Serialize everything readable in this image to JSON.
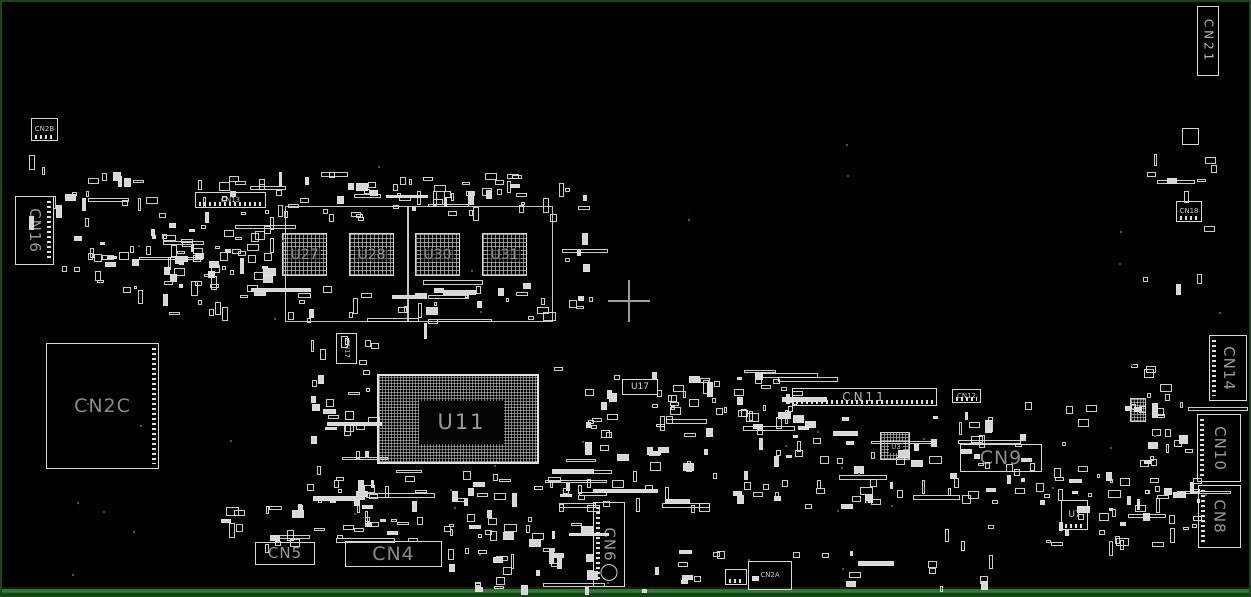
{
  "app": {
    "type": "pcb-boardview-screen",
    "background": "#000000",
    "border_color": "#1e431e",
    "silkscreen_color": "#d8d8d8",
    "label_color": "#8f8f8f",
    "edge_strip_color": "#247524"
  },
  "crosshair": {
    "x": 627,
    "y": 299,
    "arm": 21,
    "thickness": 2,
    "color": "#a39a9e"
  },
  "components": [
    {
      "id": "CN21",
      "label": "CN21",
      "x": 1195,
      "y": 4,
      "w": 22,
      "h": 70,
      "type": "box",
      "ls": "sm2",
      "vert": true
    },
    {
      "id": "CN2B",
      "label": "CN2B",
      "x": 29,
      "y": 116,
      "w": 27,
      "h": 23,
      "type": "box",
      "ls": "xs",
      "pins": "bottom"
    },
    {
      "id": "CN16",
      "label": "CN16",
      "x": 13,
      "y": 194,
      "w": 39,
      "h": 69,
      "type": "box",
      "ls": "md",
      "vert": true,
      "pins": "right"
    },
    {
      "id": "CN13",
      "label": "CN13",
      "x": 193,
      "y": 190,
      "w": 71,
      "h": 16,
      "type": "box",
      "ls": "xs",
      "pins": "bottom"
    },
    {
      "id": "CN2C",
      "label": "CN2C",
      "x": 44,
      "y": 341,
      "w": 113,
      "h": 126,
      "type": "box",
      "ls": "lg",
      "pins": "right"
    },
    {
      "id": "CN17",
      "label": "CN17",
      "x": 334,
      "y": 331,
      "w": 21,
      "h": 31,
      "type": "box",
      "ls": "xs",
      "vert": true
    },
    {
      "id": "U27",
      "label": "U27",
      "x": 280,
      "y": 231,
      "w": 45,
      "h": 43,
      "type": "mem"
    },
    {
      "id": "U28",
      "label": "U28",
      "x": 347,
      "y": 231,
      "w": 45,
      "h": 43,
      "type": "mem"
    },
    {
      "id": "U30",
      "label": "U30",
      "x": 413,
      "y": 231,
      "w": 45,
      "h": 43,
      "type": "mem"
    },
    {
      "id": "U31",
      "label": "U31",
      "x": 480,
      "y": 231,
      "w": 45,
      "h": 43,
      "type": "mem"
    },
    {
      "id": "U11",
      "label": "U11",
      "x": 375,
      "y": 372,
      "w": 162,
      "h": 90,
      "type": "cpu",
      "core": {
        "dx": 40,
        "dy": 25,
        "w": 85,
        "h": 43
      }
    },
    {
      "id": "U17",
      "label": "U17",
      "x": 620,
      "y": 377,
      "w": 36,
      "h": 16,
      "type": "box",
      "ls": "sm"
    },
    {
      "id": "CN11",
      "label": "CN11",
      "x": 790,
      "y": 386,
      "w": 145,
      "h": 18,
      "type": "box",
      "ls": "sm2",
      "pins": "bottom"
    },
    {
      "id": "CN12",
      "label": "CN12",
      "x": 950,
      "y": 387,
      "w": 29,
      "h": 14,
      "type": "box",
      "ls": "xs",
      "pins": "bottom"
    },
    {
      "id": "U3",
      "label": "U3",
      "x": 878,
      "y": 430,
      "w": 30,
      "h": 28,
      "type": "bga",
      "core": {
        "dx": 8,
        "dy": 9,
        "w": 14,
        "h": 11
      }
    },
    {
      "id": "CN9",
      "label": "CN9",
      "x": 958,
      "y": 442,
      "w": 82,
      "h": 28,
      "type": "box",
      "ls": "lg"
    },
    {
      "id": "U7",
      "label": "U7",
      "x": 1059,
      "y": 498,
      "w": 27,
      "h": 30,
      "type": "box",
      "ls": "sm",
      "pins": "bottom"
    },
    {
      "id": "CN18",
      "label": "CN18",
      "x": 1174,
      "y": 199,
      "w": 26,
      "h": 21,
      "type": "box",
      "ls": "xs",
      "pins": "bottom"
    },
    {
      "id": "CN14",
      "label": "CN14",
      "x": 1207,
      "y": 333,
      "w": 38,
      "h": 66,
      "type": "box",
      "ls": "md",
      "vert": true,
      "pins": "left"
    },
    {
      "id": "CN10",
      "label": "CN10",
      "x": 1195,
      "y": 412,
      "w": 44,
      "h": 68,
      "type": "box",
      "ls": "md",
      "vert": true,
      "pins": "left"
    },
    {
      "id": "CN8",
      "label": "CN8",
      "x": 1196,
      "y": 483,
      "w": 43,
      "h": 63,
      "type": "box",
      "ls": "md",
      "vert": true,
      "pins": "left"
    },
    {
      "id": "CN5",
      "label": "CN5",
      "x": 253,
      "y": 540,
      "w": 60,
      "h": 23,
      "type": "box",
      "ls": "md"
    },
    {
      "id": "CN4",
      "label": "CN4",
      "x": 343,
      "y": 539,
      "w": 97,
      "h": 26,
      "type": "box",
      "ls": "lg"
    },
    {
      "id": "CN6",
      "label": "CN6",
      "x": 591,
      "y": 500,
      "w": 32,
      "h": 85,
      "type": "box",
      "ls": "md",
      "vert": true,
      "pins": "left",
      "hole": true
    },
    {
      "id": "CN2A",
      "label": "CN2A",
      "x": 746,
      "y": 559,
      "w": 44,
      "h": 29,
      "type": "box",
      "ls": "xs"
    },
    {
      "id": "conn-small-1",
      "label": "",
      "x": 723,
      "y": 567,
      "w": 22,
      "h": 16,
      "type": "box",
      "pins": "bottom"
    },
    {
      "id": "chip-sq-1",
      "label": "",
      "x": 1180,
      "y": 126,
      "w": 17,
      "h": 17,
      "type": "box"
    },
    {
      "id": "bga-sm-1",
      "label": "",
      "x": 1128,
      "y": 396,
      "w": 16,
      "h": 24,
      "type": "bgapad"
    }
  ],
  "frames": [
    {
      "x": 283,
      "y": 204,
      "w": 123,
      "h": 116
    },
    {
      "x": 406,
      "y": 204,
      "w": 145,
      "h": 116
    }
  ],
  "clusters": [
    {
      "x": 62,
      "y": 168,
      "w": 205,
      "h": 120,
      "n": 85,
      "seed": 1
    },
    {
      "x": 150,
      "y": 232,
      "w": 120,
      "h": 78,
      "n": 30,
      "seed": 2
    },
    {
      "x": 268,
      "y": 168,
      "w": 290,
      "h": 48,
      "n": 60,
      "seed": 3
    },
    {
      "x": 278,
      "y": 278,
      "w": 280,
      "h": 44,
      "n": 35,
      "seed": 4
    },
    {
      "x": 288,
      "y": 330,
      "w": 88,
      "h": 188,
      "n": 40,
      "seed": 5
    },
    {
      "x": 300,
      "y": 465,
      "w": 290,
      "h": 72,
      "n": 66,
      "seed": 6
    },
    {
      "x": 545,
      "y": 365,
      "w": 245,
      "h": 140,
      "n": 85,
      "seed": 7
    },
    {
      "x": 558,
      "y": 182,
      "w": 30,
      "h": 130,
      "n": 12,
      "seed": 8
    },
    {
      "x": 790,
      "y": 408,
      "w": 175,
      "h": 95,
      "n": 45,
      "seed": 9
    },
    {
      "x": 940,
      "y": 400,
      "w": 250,
      "h": 140,
      "n": 58,
      "seed": 10
    },
    {
      "x": 1040,
      "y": 460,
      "w": 155,
      "h": 85,
      "n": 32,
      "seed": 11
    },
    {
      "x": 630,
      "y": 548,
      "w": 380,
      "h": 40,
      "n": 22,
      "seed": 12
    },
    {
      "x": 1140,
      "y": 150,
      "w": 70,
      "h": 150,
      "n": 12,
      "seed": 13
    },
    {
      "x": 1125,
      "y": 360,
      "w": 72,
      "h": 100,
      "n": 18,
      "seed": 14
    },
    {
      "x": 745,
      "y": 380,
      "w": 50,
      "h": 40,
      "n": 8,
      "seed": 15
    },
    {
      "x": 25,
      "y": 150,
      "w": 40,
      "h": 118,
      "n": 6,
      "seed": 16
    },
    {
      "x": 660,
      "y": 368,
      "w": 128,
      "h": 46,
      "n": 18,
      "seed": 17
    },
    {
      "x": 215,
      "y": 500,
      "w": 130,
      "h": 42,
      "n": 18,
      "seed": 18
    },
    {
      "x": 445,
      "y": 540,
      "w": 140,
      "h": 46,
      "n": 25,
      "seed": 19
    }
  ],
  "green_dots": [
    {
      "seed": 20,
      "n": 28,
      "x": 30,
      "y": 420,
      "w": 1190,
      "h": 165
    },
    {
      "seed": 21,
      "n": 14,
      "x": 30,
      "y": 90,
      "w": 1190,
      "h": 320
    }
  ]
}
